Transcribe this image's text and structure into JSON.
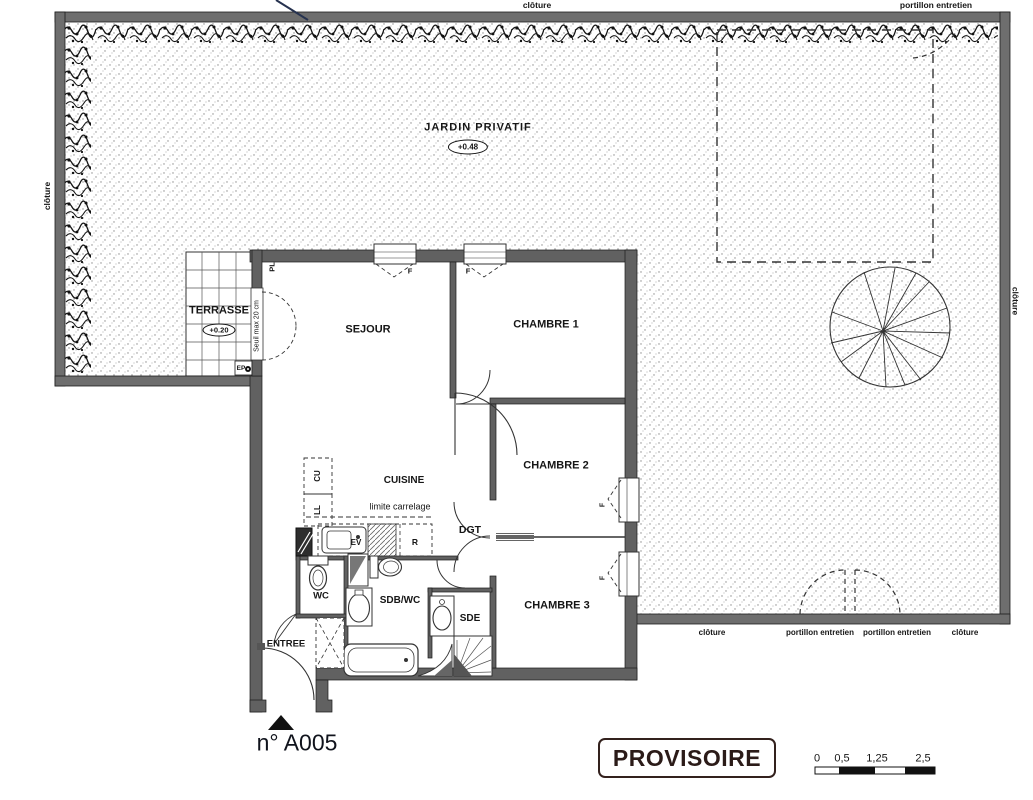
{
  "garden": {
    "label": "JARDIN PRIVATIF",
    "level": "+0.48",
    "cloture_top": "clôture",
    "portillon_top": "portillon entretien",
    "cloture_left": "clôture",
    "cloture_right": "clôture",
    "bottom_labels": [
      "clôture",
      "portillon entretien",
      "portillon entretien",
      "clôture"
    ]
  },
  "terrasse": {
    "label": "TERRASSE",
    "level": "+0.20",
    "seuil": "Seuil max 20 cm",
    "pl": "PL",
    "ep": "EP"
  },
  "rooms": {
    "sejour": "SEJOUR",
    "chambre1": "CHAMBRE 1",
    "chambre2": "CHAMBRE 2",
    "chambre3": "CHAMBRE 3",
    "cuisine": "CUISINE",
    "dgt": "DGT",
    "wc": "WC",
    "sdb_wc": "SDB/WC",
    "sde": "SDE",
    "entree": "ENTREE"
  },
  "kitchen": {
    "limite": "limite carrelage",
    "cu": "CU",
    "ll": "LL",
    "ev": "EV",
    "r": "R"
  },
  "windows": {
    "label": "F"
  },
  "unit": {
    "number": "n° A005"
  },
  "stamp": {
    "label": "PROVISOIRE"
  },
  "scale_bar": {
    "ticks": [
      "0",
      "0,5",
      "1,25",
      "2,5"
    ]
  },
  "colors": {
    "wall": "#616161",
    "line": "#1c1c1c",
    "stamp_text": "#2b1b18"
  }
}
